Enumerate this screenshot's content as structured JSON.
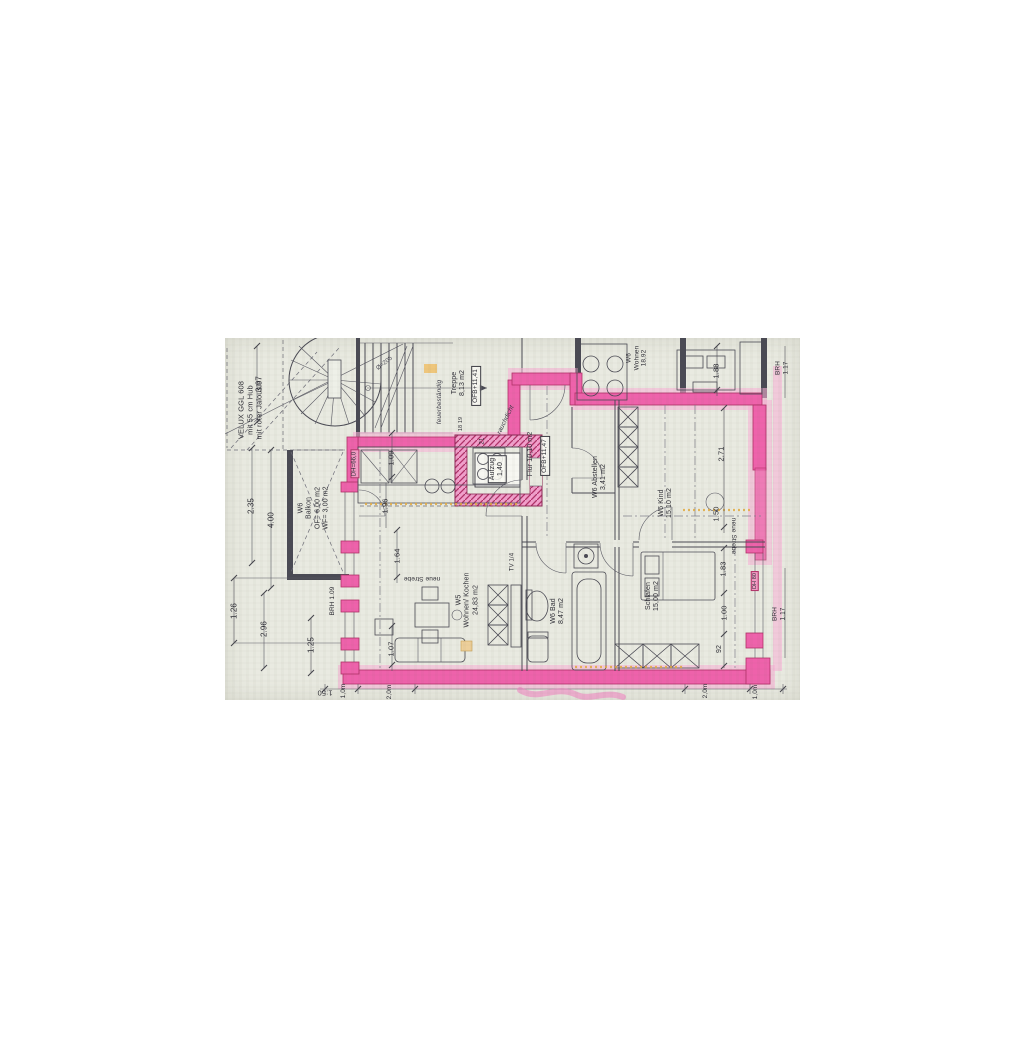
{
  "document": {
    "type": "scanned floor plan (Grundriss)",
    "scale_label": "1:50"
  },
  "colors": {
    "paper": "#e9eae1",
    "ink": "#4a4a54",
    "highlight_pink": "#ee62ab",
    "highlight_pink_light": "#f7b3d6",
    "highlight_pink_dark": "#b13168",
    "accent_orange": "#e2aa3f"
  },
  "labels": [
    {
      "id": "velux-note",
      "text": "VELUX GGL 608\nmit 55 cm Hub\nmit roter Jalousie",
      "x": 26,
      "y": 72,
      "size": 7.5,
      "rot": -90
    },
    {
      "id": "dim-3-97",
      "text": "3.97",
      "x": 34,
      "y": 46,
      "size": 8,
      "rot": -90
    },
    {
      "id": "dim-2-35",
      "text": "2.35",
      "x": 26,
      "y": 168,
      "size": 8,
      "rot": -90
    },
    {
      "id": "dim-4-00",
      "text": "4.00",
      "x": 46,
      "y": 182,
      "size": 8,
      "rot": -90
    },
    {
      "id": "dim-1-26",
      "text": "1.26",
      "x": 9,
      "y": 273,
      "size": 8,
      "rot": -90
    },
    {
      "id": "dim-2-96",
      "text": "2.96",
      "x": 39,
      "y": 291,
      "size": 8,
      "rot": -90
    },
    {
      "id": "dim-1-25",
      "text": "1.25",
      "x": 86,
      "y": 307,
      "size": 8,
      "rot": -90
    },
    {
      "id": "scale-note",
      "text": "1:50",
      "x": 100,
      "y": 354,
      "size": 7.5,
      "rot": 180
    },
    {
      "id": "room-balkon",
      "text": "W6\nBalkon\nOF= 6,00 m2\nWF= 3,00 m2",
      "x": 89,
      "y": 170,
      "size": 7,
      "rot": -90
    },
    {
      "id": "brh-1-09",
      "text": "BRH 1.09",
      "x": 108,
      "y": 263,
      "size": 6.5,
      "rot": -90
    },
    {
      "id": "dim-1-64",
      "text": "1.64",
      "x": 173,
      "y": 218,
      "size": 7.5,
      "rot": -90
    },
    {
      "id": "note-neue-strebe-1",
      "text": "neue Strebe",
      "x": 197,
      "y": 240,
      "size": 6.5,
      "rot": 180
    },
    {
      "id": "dim-1-07",
      "text": "1.07",
      "x": 167,
      "y": 311,
      "size": 7.5,
      "rot": -90
    },
    {
      "id": "room-wohnen-kochen",
      "text": "W5\nWohnen/ Kochen\n24,83 m2",
      "x": 243,
      "y": 262,
      "size": 7,
      "rot": -90
    },
    {
      "id": "note-tv",
      "text": "TV 1/4",
      "x": 288,
      "y": 224,
      "size": 6,
      "rot": -90
    },
    {
      "id": "dim-1-09",
      "text": "1.09",
      "x": 167,
      "y": 120,
      "size": 7.5,
      "rot": -90
    },
    {
      "id": "dim-1-96",
      "text": "1.96",
      "x": 161,
      "y": 168,
      "size": 7.5,
      "rot": -90
    },
    {
      "id": "note-dh-66",
      "text": "DH=66,0",
      "x": 130,
      "y": 126,
      "size": 6,
      "rot": -90,
      "cls": "pinkbg"
    },
    {
      "id": "room-bad",
      "text": "W6 Bad\n8,47 m2",
      "x": 333,
      "y": 273,
      "size": 7,
      "rot": -90
    },
    {
      "id": "room-schlafen",
      "text": "Schlafen\n15,00 m2",
      "x": 428,
      "y": 258,
      "size": 7,
      "rot": -90
    },
    {
      "id": "note-neue-strebe-2",
      "text": "neue Strebe",
      "x": 508,
      "y": 198,
      "size": 6.5,
      "rot": 90
    },
    {
      "id": "dim-1-83",
      "text": "1.83",
      "x": 499,
      "y": 231,
      "size": 7.5,
      "rot": -90
    },
    {
      "id": "dim-1-00",
      "text": "1.00",
      "x": 500,
      "y": 275,
      "size": 7.5,
      "rot": -90
    },
    {
      "id": "dim-92",
      "text": "92",
      "x": 495,
      "y": 311,
      "size": 7,
      "rot": -90
    },
    {
      "id": "brh-1-17-low",
      "text": "BRH 1.17",
      "x": 554,
      "y": 276,
      "size": 6.5,
      "rot": -90
    },
    {
      "id": "note-dh-80",
      "text": "DH 80",
      "x": 530,
      "y": 243,
      "size": 5.5,
      "rot": -90,
      "cls": "pinkbg"
    },
    {
      "id": "dim-1-50",
      "text": "1.50",
      "x": 492,
      "y": 176,
      "size": 7.5,
      "rot": -90
    },
    {
      "id": "dim-2-71",
      "text": "2.71",
      "x": 497,
      "y": 116,
      "size": 7.5,
      "rot": -90
    },
    {
      "id": "room-kind",
      "text": "W6 Kind\n15,10 m2",
      "x": 441,
      "y": 165,
      "size": 7,
      "rot": -90
    },
    {
      "id": "room-abstellen",
      "text": "W6 Abstellen\n3,41 m2",
      "x": 375,
      "y": 139,
      "size": 7,
      "rot": -90
    },
    {
      "id": "room-flur",
      "text": "Flur 10,10 m2",
      "x": 306,
      "y": 116,
      "size": 7,
      "rot": -90
    },
    {
      "id": "flur-ofb",
      "text": "OFB+11,47",
      "x": 320,
      "y": 118,
      "size": 6.5,
      "rot": -90,
      "cls": "boxed"
    },
    {
      "id": "room-treppe",
      "text": "Treppe\n8,13 m2",
      "x": 234,
      "y": 45,
      "size": 7,
      "rot": -90
    },
    {
      "id": "treppe-ofb",
      "text": "OFB+11,41",
      "x": 251,
      "y": 48,
      "size": 6.5,
      "rot": -90,
      "cls": "boxed"
    },
    {
      "id": "note-feuerbestaendig",
      "text": "feuerbeständig",
      "x": 215,
      "y": 64,
      "size": 6.5,
      "rot": -90,
      "cls": "ital"
    },
    {
      "id": "note-rauchdicht",
      "text": "rauchdicht",
      "x": 281,
      "y": 82,
      "size": 6.5,
      "rot": -64,
      "cls": "ital"
    },
    {
      "id": "label-aufzug",
      "text": "Aufzug\n1,40",
      "x": 272,
      "y": 131,
      "size": 7,
      "rot": -90,
      "cls": "boxed"
    },
    {
      "id": "num-21",
      "text": "21",
      "x": 258,
      "y": 103,
      "size": 6,
      "rot": -90
    },
    {
      "id": "nums-18-19",
      "text": "18 19",
      "x": 236,
      "y": 86,
      "size": 5.5,
      "rot": -90
    },
    {
      "id": "room-wohnen-w6",
      "text": "W6\nWohnen\n18,92",
      "x": 412,
      "y": 20,
      "size": 6.5,
      "rot": -90
    },
    {
      "id": "dim-1-88",
      "text": "1.88",
      "x": 492,
      "y": 33,
      "size": 7.5,
      "rot": -90
    },
    {
      "id": "brh-1-17-top",
      "text": "BRH 1.17",
      "x": 557,
      "y": 30,
      "size": 6.5,
      "rot": -90
    },
    {
      "id": "note-spiral",
      "text": "Ø=205",
      "x": 160,
      "y": 26,
      "size": 6,
      "rot": -38,
      "cls": "faint"
    },
    {
      "id": "scalebar-1-0m-left",
      "text": "1,0m",
      "x": 119,
      "y": 353,
      "size": 6.5,
      "rot": -90
    },
    {
      "id": "scalebar-2-0m-left",
      "text": "2,0m",
      "x": 165,
      "y": 354,
      "size": 6.5,
      "rot": -90
    },
    {
      "id": "scalebar-2-0m-right",
      "text": "2,0m",
      "x": 481,
      "y": 353,
      "size": 6.5,
      "rot": -90
    },
    {
      "id": "scalebar-1-0m-right",
      "text": "1,0m",
      "x": 531,
      "y": 354,
      "size": 6.5,
      "rot": -90
    }
  ]
}
